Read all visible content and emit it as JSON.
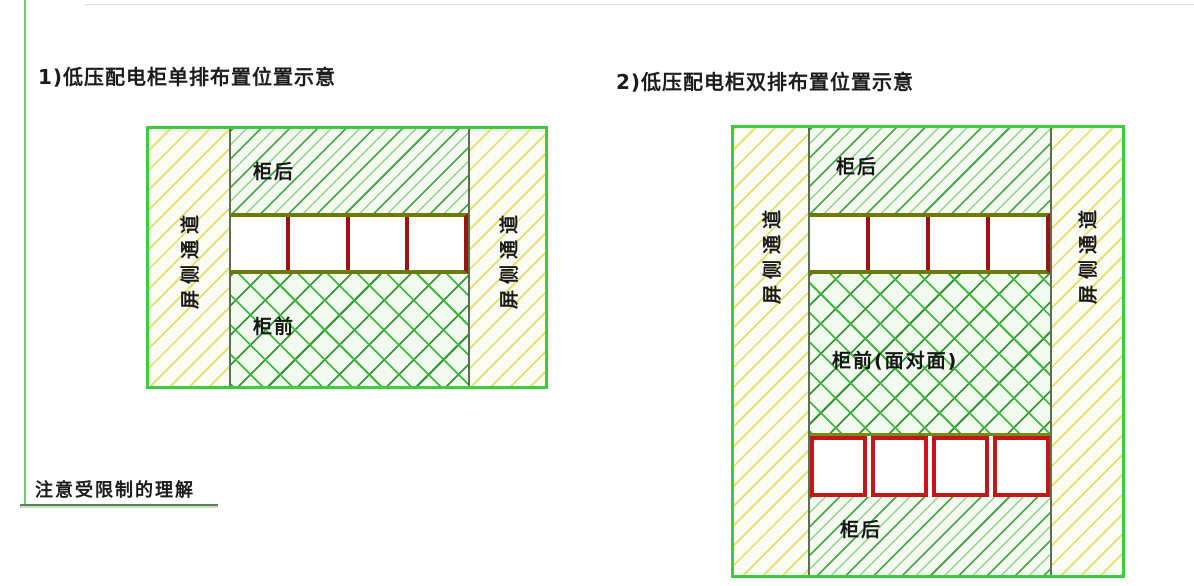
{
  "titles": {
    "diagram1": "1)低压配电柜单排布置位置示意",
    "diagram2": "2)低压配电柜双排布置位置示意"
  },
  "note": "注意受限制的理解",
  "diagram1": {
    "aisle_left": "屏侧通道",
    "aisle_right": "屏侧通道",
    "back_area": "柜后",
    "front_area": "柜前",
    "cabinet_count": 4
  },
  "diagram2": {
    "aisle_left": "屏侧通道",
    "aisle_right": "屏侧通道",
    "back_area_top": "柜后",
    "front_area": "柜前(面对面)",
    "back_area_bottom": "柜后",
    "cabinet_count_row1": 4,
    "cabinet_count_row2": 4
  },
  "colors": {
    "diagram_border_green": "#3fcb3f",
    "hatch_green": "#4aa54a",
    "crosshatch_green": "#39b839",
    "aisle_hatch_yellow": "#e4e174",
    "aisle_hatch_green": "#b7e49a",
    "row_frame_olive": "#6e7a06",
    "cabinet_divider_red": "#9e1212",
    "cabinet_border_red": "#c41717",
    "text": "#1c1c1c"
  }
}
